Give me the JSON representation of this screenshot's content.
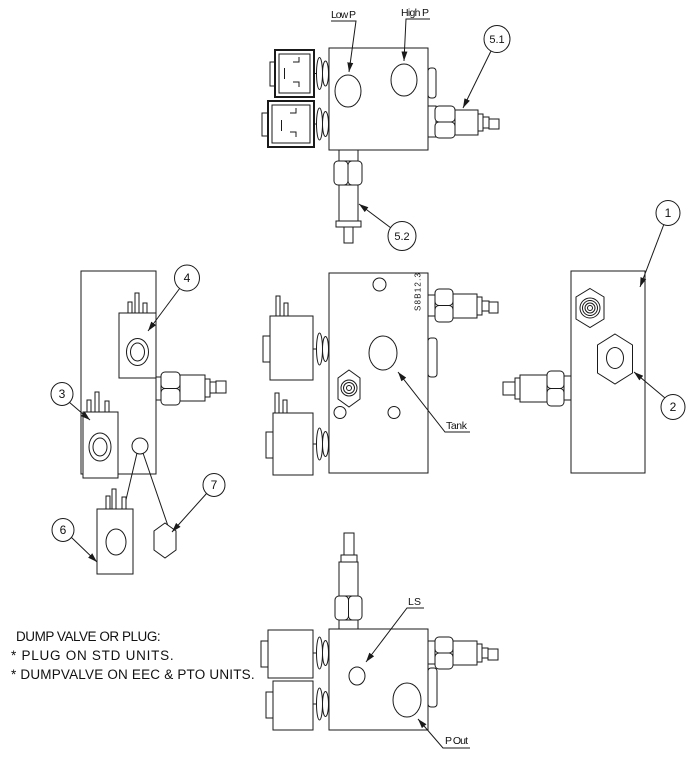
{
  "ports": {
    "low_p": "Low P",
    "high_p": "High P",
    "tank": "Tank",
    "ls": "LS",
    "p_out": "P Out"
  },
  "callouts": {
    "item_1": "1",
    "item_2": "2",
    "item_3": "3",
    "item_4": "4",
    "item_5_1": "5.1",
    "item_5_2": "5.2",
    "item_6": "6",
    "item_7": "7"
  },
  "note": {
    "heading": "DUMP VALVE OR PLUG:",
    "line1": "* PLUG ON STD UNITS.",
    "line2": "* DUMPVALVE ON EEC & PTO UNITS."
  },
  "block_marking": "S8B12.3",
  "colors": {
    "line": "#1a1a1a",
    "background": "#ffffff"
  }
}
